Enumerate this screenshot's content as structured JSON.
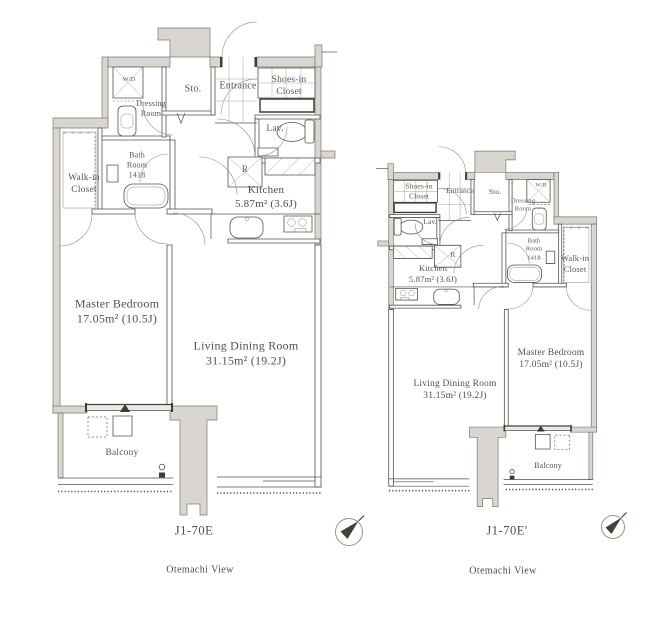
{
  "page": {
    "background": "#ffffff"
  },
  "colors": {
    "wall_fill": "#d9d5d0",
    "line": "#55524c",
    "label_text": "#5a5751",
    "compass_needle": "#474039"
  },
  "plans": [
    {
      "caption": "J1-70E",
      "view_label": "Otemachi View",
      "rooms": {
        "master_bedroom": "Master Bedroom\n17.05m²  (10.5J)",
        "living_dining_room": "Living Dining Room\n31.15m²  (19.2J)",
        "kitchen": "Kitchen\n5.87m²  (3.6J)",
        "balcony": "Balcony",
        "walk_in_closet": "Walk-in\nCloset",
        "bath_room": "Bath\nRoom\n1418",
        "dressing_room": "Dressing\nRoom",
        "washer_dryer": "W/D",
        "storage": "Sto.",
        "entrance": "Entrance",
        "shoes_in_closet": "Shoes-in\nCloset",
        "lavatory": "Lav.",
        "refrigerator": "R"
      }
    },
    {
      "caption": "J1-70E'",
      "view_label": "Otemachi View",
      "rooms": {
        "master_bedroom": "Master Bedroom\n17.05m²  (10.5J)",
        "living_dining_room": "Living Dining Room\n31.15m²  (19.2J)",
        "kitchen": "Kitchen\n5.87m²  (3.6J)",
        "balcony": "Balcony",
        "walk_in_closet": "Walk-in\nCloset",
        "bath_room": "Bath\nRoom\n1418",
        "dressing_room": "Dressing\nRoom",
        "washer_dryer": "W/D",
        "storage": "Sto.",
        "entrance": "Entrance",
        "shoes_in_closet": "Shoes-in\nCloset",
        "lavatory": "Lav.",
        "refrigerator": "R"
      }
    }
  ]
}
